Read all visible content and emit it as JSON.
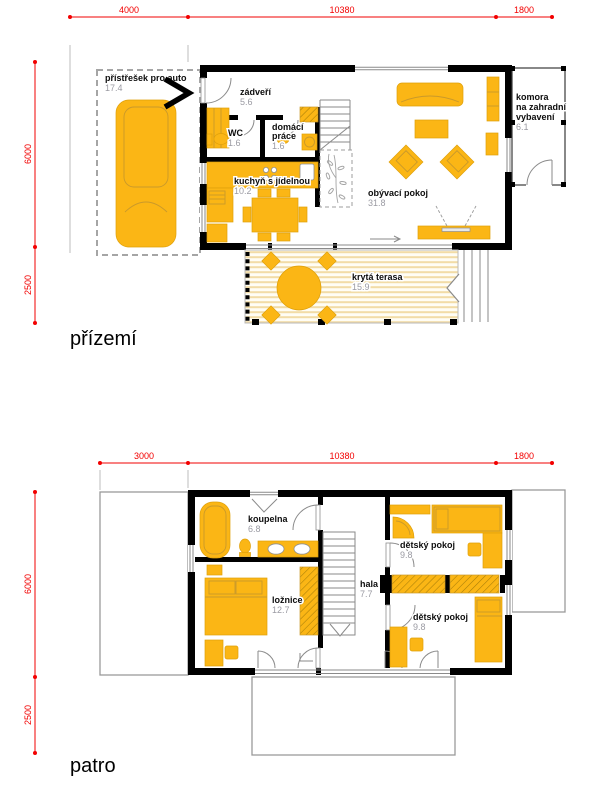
{
  "page": {
    "background": "#ffffff"
  },
  "colors": {
    "furniture_orange": "#FBB615",
    "wall_black": "#000000",
    "dimension_red": "#FF0000",
    "area_text_gray": "#9B9BA3",
    "deck_stripe": "#F2DCA6",
    "roof_outline_gray": "#9A9A9A"
  },
  "ground": {
    "title": "přízemí",
    "dims_top": [
      "4000",
      "10380",
      "1800"
    ],
    "dims_left": [
      "6000",
      "2500"
    ],
    "rooms": {
      "carport": {
        "name": "přístřešek pro auto",
        "area": "17.4"
      },
      "zadveri": {
        "name": "zádveří",
        "area": "5.6"
      },
      "wc": {
        "name": "WC",
        "area": "1.6"
      },
      "domaci_prace": {
        "line1": "domácí",
        "line2": "práce",
        "area": "1.6"
      },
      "kuchyn": {
        "name": "kuchyň s jídelnou",
        "area": "10.2"
      },
      "obyvaci": {
        "name": "obývací pokoj",
        "area": "31.8"
      },
      "komora": {
        "line1": "komora",
        "line2": "na zahradní",
        "line3": "vybavení",
        "area": "6.1"
      },
      "terasa": {
        "name": "krytá terasa",
        "area": "15.9"
      }
    }
  },
  "upper": {
    "title": "patro",
    "dims_top": [
      "3000",
      "10380",
      "1800"
    ],
    "dims_left": [
      "6000",
      "2500"
    ],
    "rooms": {
      "koupelna": {
        "name": "koupelna",
        "area": "6.8"
      },
      "loznice": {
        "name": "ložnice",
        "area": "12.7"
      },
      "hala": {
        "name": "hala",
        "area": "7.7"
      },
      "detsky1": {
        "name": "dětský pokoj",
        "area": "9.8"
      },
      "detsky2": {
        "name": "dětský pokoj",
        "area": "9.8"
      }
    }
  }
}
